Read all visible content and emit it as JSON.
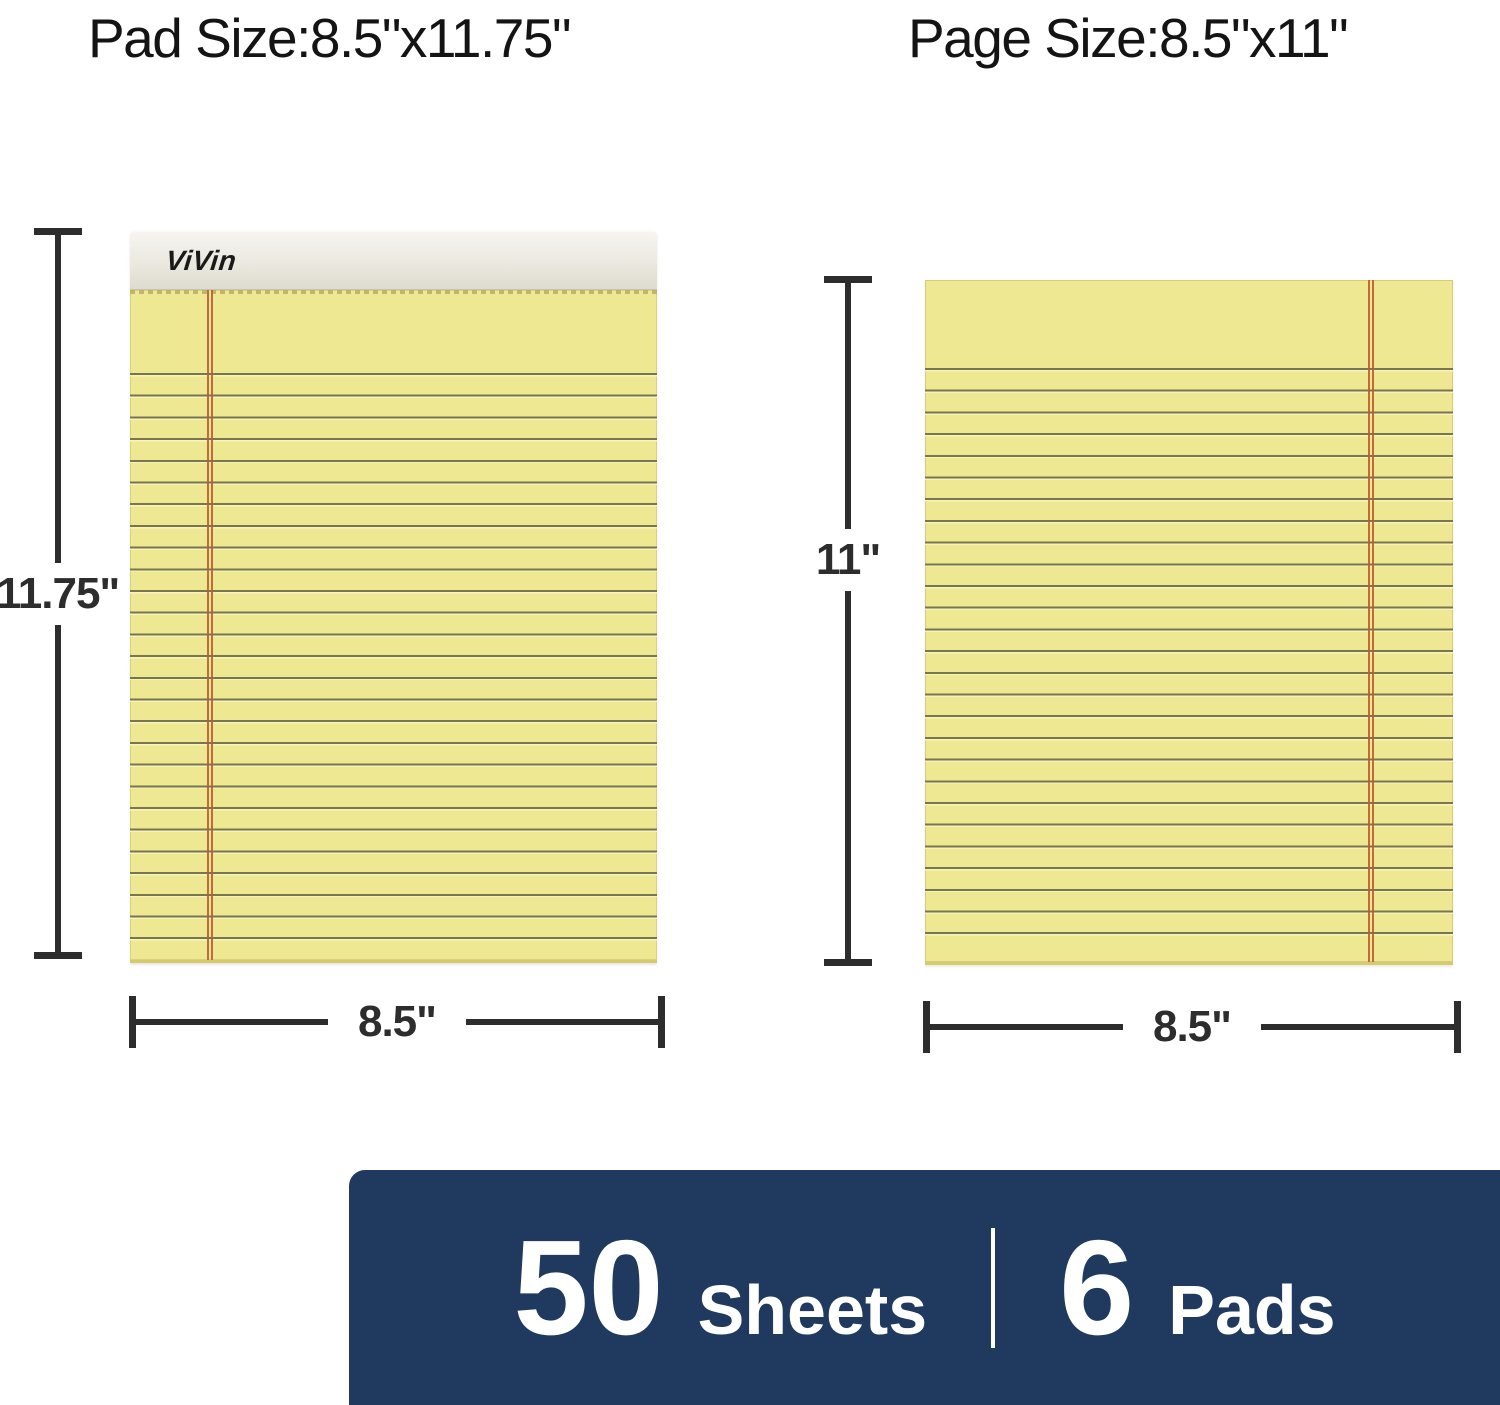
{
  "titles": {
    "pad_size": "Pad Size:8.5\"x11.75\"",
    "page_size": "Page Size:8.5\"x11\""
  },
  "brand": {
    "logo": "ViVin"
  },
  "dimensions": {
    "pad": {
      "height": "11.75\"",
      "width": "8.5\""
    },
    "page": {
      "height": "11\"",
      "width": "8.5\""
    }
  },
  "banner": {
    "sheets_count": "50",
    "sheets_label": "Sheets",
    "pads_count": "6",
    "pads_label": "Pads"
  },
  "colors": {
    "banner_navy": "#1f3a5e",
    "banner_text": "#ffffff",
    "paper_yellow": "#efe893",
    "ruling_olive": "#76764f",
    "margin_red": "#bc5c31",
    "dimension_dark": "#2d2d2d",
    "binding_gray": "#ebe8e0"
  }
}
